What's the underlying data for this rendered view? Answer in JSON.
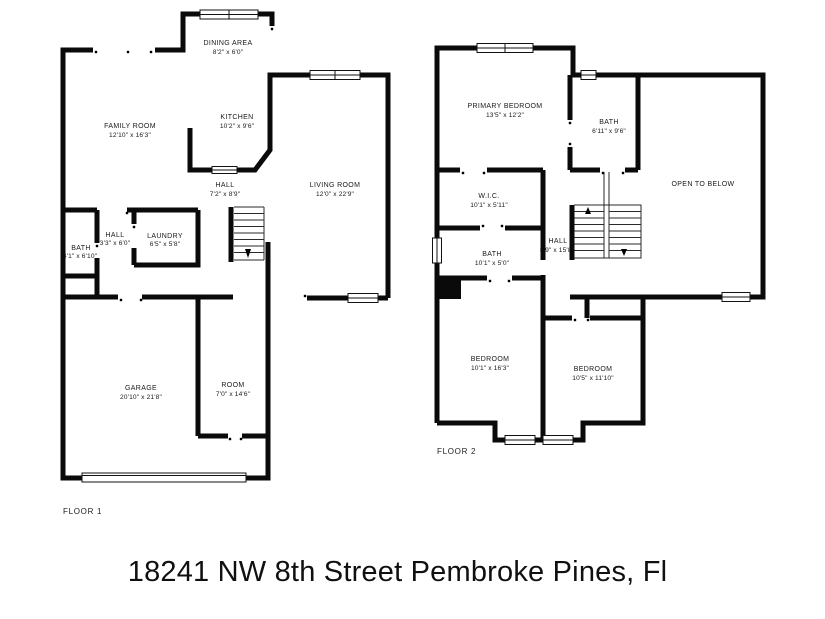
{
  "address": "18241 NW 8th Street Pembroke Pines, Fl",
  "colors": {
    "wall": "#0a0a0a",
    "background": "#ffffff",
    "label_text": "#1a1a1a"
  },
  "floor1": {
    "label": "FLOOR 1",
    "rooms": {
      "dining": {
        "name": "DINING AREA",
        "dims": "8'2\" x 6'0\""
      },
      "kitchen": {
        "name": "KITCHEN",
        "dims": "10'2\" x 9'6\""
      },
      "family": {
        "name": "FAMILY ROOM",
        "dims": "12'10\" x 16'3\""
      },
      "hall": {
        "name": "HALL",
        "dims": "7'2\" x 8'9\""
      },
      "living": {
        "name": "LIVING ROOM",
        "dims": "12'0\" x 22'9\""
      },
      "hall2": {
        "name": "HALL",
        "dims": "3'3\" x 6'0\""
      },
      "laundry": {
        "name": "LAUNDRY",
        "dims": "6'5\" x 5'8\""
      },
      "bath": {
        "name": "BATH",
        "dims": "4'1\" x 6'10\""
      },
      "garage": {
        "name": "GARAGE",
        "dims": "20'10\" x 21'8\""
      },
      "room": {
        "name": "ROOM",
        "dims": "7'0\" x 14'6\""
      }
    }
  },
  "floor2": {
    "label": "FLOOR 2",
    "rooms": {
      "primary": {
        "name": "PRIMARY BEDROOM",
        "dims": "13'5\" x 12'2\""
      },
      "bath_upper": {
        "name": "BATH",
        "dims": "6'11\" x 9'6\""
      },
      "open_to_below": {
        "name": "OPEN TO BELOW"
      },
      "wic": {
        "name": "W.I.C.",
        "dims": "10'1\" x 5'11\""
      },
      "bath_mid": {
        "name": "BATH",
        "dims": "10'1\" x 5'0\""
      },
      "hall": {
        "name": "HALL",
        "dims": "8'9\" x 15'8\""
      },
      "bedroom_left": {
        "name": "BEDROOM",
        "dims": "10'1\" x 16'3\""
      },
      "bedroom_right": {
        "name": "BEDROOM",
        "dims": "10'5\" x 11'10\""
      }
    }
  }
}
